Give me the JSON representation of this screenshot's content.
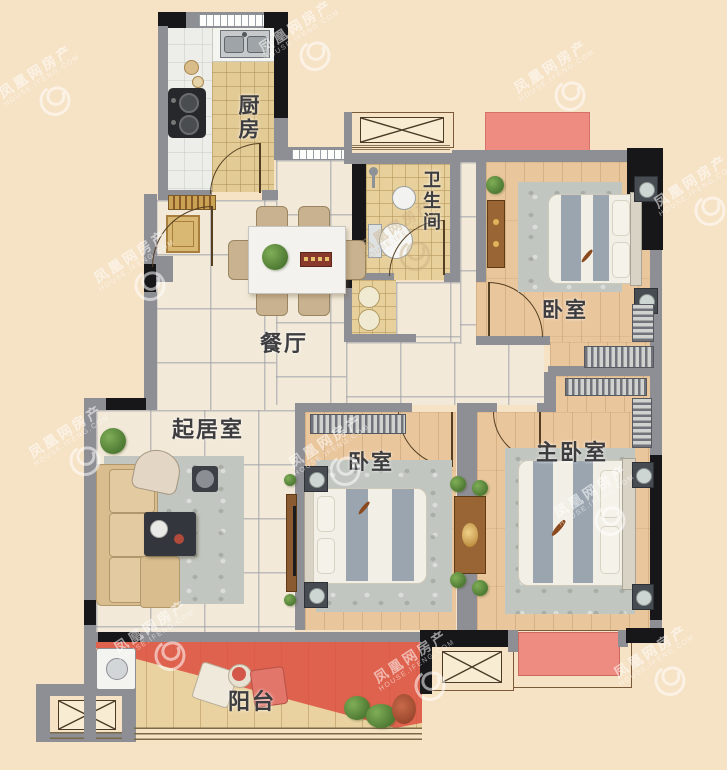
{
  "watermark": {
    "brand": "凤凰网房产",
    "domain": "HOUSE.IFENG.COM"
  },
  "rooms": [
    {
      "id": "kitchen",
      "label": "厨房"
    },
    {
      "id": "bathroom",
      "label": "卫生间"
    },
    {
      "id": "bedroom-north",
      "label": "卧室"
    },
    {
      "id": "dining-room",
      "label": "餐厅"
    },
    {
      "id": "living-room",
      "label": "起居室"
    },
    {
      "id": "bedroom-middle",
      "label": "卧室"
    },
    {
      "id": "master-bedroom",
      "label": "主卧室"
    },
    {
      "id": "balcony",
      "label": "阳台"
    }
  ],
  "colors": {
    "background": "#f6e2c5",
    "wall_gray": "#8e8e95",
    "wall_black": "#17171a",
    "marble_floor": "#f2e9d8",
    "wood_floor": "#e9c69c",
    "balcony_highlight_red": "#dd5244",
    "flower_bed_pink": "#ef8c82"
  }
}
